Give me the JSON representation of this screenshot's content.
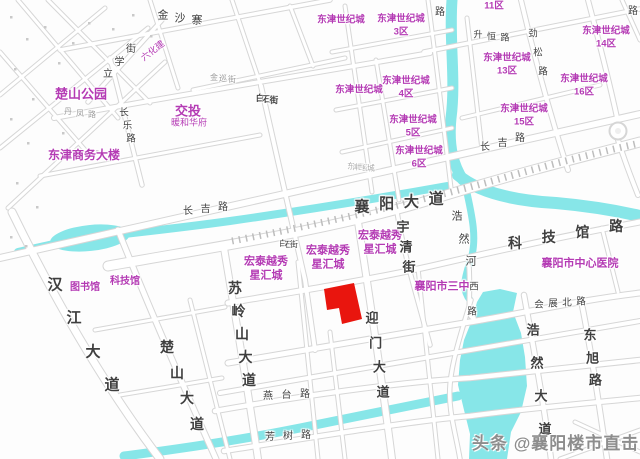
{
  "map": {
    "width": 640,
    "height": 459,
    "colors": {
      "water": "#87e6e8",
      "road_casing": "#d6d6d6",
      "road_fill": "#ffffff",
      "rail_tick": "#bdbdbd",
      "poi": "#b43bb4",
      "road_label": "#3f3f3f",
      "tiny_label": "#9b9b9b",
      "parcel": "#e9150e",
      "watermark": "#8d8d8d",
      "tree": "#c9c9c9"
    },
    "watermark": {
      "text": "头条 @襄阳楼市直击",
      "x": 472,
      "y": 429,
      "size": 17
    },
    "parcel": {
      "points": "324,289 354,283 362,319 342,324 339,308 327,310"
    },
    "roundabout": {
      "cx": 618,
      "cy": 131,
      "r": 8.5
    },
    "poi_labels": [
      {
        "lines": [
          "楚山公园"
        ],
        "x": 81,
        "y": 94,
        "size": 13,
        "bold": true
      },
      {
        "lines": [
          "东津商务大楼"
        ],
        "x": 84,
        "y": 155,
        "size": 12,
        "bold": true
      },
      {
        "lines": [
          "交投"
        ],
        "x": 188,
        "y": 111,
        "size": 13,
        "bold": true
      },
      {
        "lines": [
          "暖和华府"
        ],
        "x": 189,
        "y": 123,
        "size": 9,
        "bold": false
      },
      {
        "lines": [
          "六化建"
        ],
        "x": 153,
        "y": 51,
        "size": 9,
        "bold": false,
        "rotate": -38
      },
      {
        "lines": [
          "图书馆"
        ],
        "x": 85,
        "y": 288,
        "size": 10,
        "bold": true
      },
      {
        "lines": [
          "科技馆"
        ],
        "x": 125,
        "y": 282,
        "size": 10,
        "bold": true
      },
      {
        "lines": [
          "东津世纪城"
        ],
        "x": 341,
        "y": 20,
        "size": 9.5,
        "bold": true
      },
      {
        "lines": [
          "东津世纪城",
          "3区"
        ],
        "x": 401,
        "y": 19,
        "size": 9.5,
        "bold": true
      },
      {
        "lines": [
          "11区"
        ],
        "x": 494,
        "y": 6,
        "size": 9.5,
        "bold": true
      },
      {
        "lines": [
          "东津世纪城",
          "14区"
        ],
        "x": 606,
        "y": 31,
        "size": 9.5,
        "bold": true
      },
      {
        "lines": [
          "东津世纪城",
          "13区"
        ],
        "x": 507,
        "y": 58,
        "size": 9.5,
        "bold": true
      },
      {
        "lines": [
          "东津世纪城",
          "16区"
        ],
        "x": 584,
        "y": 79,
        "size": 9.5,
        "bold": true
      },
      {
        "lines": [
          "东津世纪城",
          "15区"
        ],
        "x": 524,
        "y": 109,
        "size": 9.5,
        "bold": true
      },
      {
        "lines": [
          "东津世纪城"
        ],
        "x": 359,
        "y": 90,
        "size": 9.5,
        "bold": true
      },
      {
        "lines": [
          "东津世纪城",
          "4区"
        ],
        "x": 406,
        "y": 81,
        "size": 9.5,
        "bold": true
      },
      {
        "lines": [
          "东津世纪城",
          "5区"
        ],
        "x": 413,
        "y": 120,
        "size": 9.5,
        "bold": true
      },
      {
        "lines": [
          "东津世纪城",
          "6区"
        ],
        "x": 419,
        "y": 151,
        "size": 9.5,
        "bold": true
      },
      {
        "lines": [
          "宏泰越秀",
          "星汇城"
        ],
        "x": 380,
        "y": 236,
        "size": 11,
        "bold": true
      },
      {
        "lines": [
          "宏泰越秀",
          "星汇城"
        ],
        "x": 328,
        "y": 251,
        "size": 11,
        "bold": true
      },
      {
        "lines": [
          "宏泰越秀",
          "星汇城"
        ],
        "x": 266,
        "y": 262,
        "size": 11,
        "bold": true
      },
      {
        "lines": [
          "襄阳市三中"
        ],
        "x": 442,
        "y": 287,
        "size": 11,
        "bold": true
      },
      {
        "lines": [
          "襄阳市中心医院"
        ],
        "x": 580,
        "y": 264,
        "size": 11,
        "bold": true
      }
    ],
    "road_labels": [
      {
        "text": "襄阳大道",
        "x": 362,
        "y": 207,
        "dx": 24.7,
        "dy": -2.7,
        "size": 15,
        "bold": true
      },
      {
        "text": "汉江大道",
        "x": 55,
        "y": 285,
        "dx": 19,
        "dy": 33.3,
        "size": 15,
        "bold": true
      },
      {
        "text": "苏岭山大道",
        "x": 235,
        "y": 288,
        "dx": 3.5,
        "dy": 23,
        "size": 14,
        "bold": true
      },
      {
        "text": "楚山大道",
        "x": 167,
        "y": 347,
        "dx": 10,
        "dy": 25.7,
        "size": 14,
        "bold": true
      },
      {
        "text": "迎门大道",
        "x": 372,
        "y": 318,
        "dx": 3.7,
        "dy": 24.7,
        "size": 13,
        "bold": true
      },
      {
        "text": "浩然大道",
        "x": 533,
        "y": 330,
        "dx": 4,
        "dy": 33,
        "size": 13,
        "bold": true
      },
      {
        "text": "东旭路",
        "x": 590,
        "y": 335,
        "dx": 2.7,
        "dy": 22.7,
        "size": 13,
        "bold": true
      },
      {
        "text": "科技馆路",
        "x": 515,
        "y": 243,
        "dx": 33.7,
        "dy": -5.7,
        "size": 14,
        "bold": true
      },
      {
        "text": "宇清街",
        "x": 403,
        "y": 227,
        "dx": 3,
        "dy": 20,
        "size": 13,
        "bold": true
      },
      {
        "text": "浩然河",
        "x": 457,
        "y": 217,
        "dx": 7,
        "dy": 22.5,
        "size": 11,
        "bold": false
      },
      {
        "text": "长吉路",
        "x": 188,
        "y": 212,
        "dx": 17.5,
        "dy": -2,
        "size": 10,
        "bold": false
      },
      {
        "text": "长吉路",
        "x": 485,
        "y": 148,
        "dx": 17.5,
        "dy": -4.5,
        "size": 10,
        "bold": false
      },
      {
        "text": "长乐路",
        "x": 124,
        "y": 113,
        "dx": 3.5,
        "dy": 13,
        "size": 9.5,
        "bold": false
      },
      {
        "text": "立学街",
        "x": 108,
        "y": 75,
        "dx": 11.5,
        "dy": -12.5,
        "size": 10,
        "bold": false
      },
      {
        "text": "金沙寨",
        "x": 163,
        "y": 16,
        "dx": 17,
        "dy": 2.5,
        "size": 11,
        "bold": false
      },
      {
        "text": "升恒路",
        "x": 478,
        "y": 35,
        "dx": 13.5,
        "dy": 1.5,
        "size": 9,
        "bold": false
      },
      {
        "text": "劲松路",
        "x": 533,
        "y": 34,
        "dx": 5,
        "dy": 19,
        "size": 9.5,
        "bold": false
      },
      {
        "text": "白石街",
        "x": 260,
        "y": 98,
        "dx": 7,
        "dy": 1,
        "size": 8.5,
        "bold": true
      },
      {
        "text": "白石街",
        "x": 283,
        "y": 244,
        "dx": 5.5,
        "dy": 0.5,
        "size": 8,
        "bold": false
      },
      {
        "text": "燕台路",
        "x": 268,
        "y": 397,
        "dx": 18.5,
        "dy": -1,
        "size": 10,
        "bold": false
      },
      {
        "text": "芳树路",
        "x": 270,
        "y": 438,
        "dx": 18,
        "dy": -1,
        "size": 10,
        "bold": false
      },
      {
        "text": "会展北路",
        "x": 539,
        "y": 305,
        "dx": 14,
        "dy": -1,
        "size": 9.5,
        "bold": false
      },
      {
        "text": "西路",
        "x": 474,
        "y": 287,
        "dx": -2,
        "dy": 25,
        "size": 9.5,
        "bold": false
      },
      {
        "text": "金巡街",
        "x": 214,
        "y": 78,
        "dx": 9,
        "dy": 1,
        "size": 8,
        "bold": false,
        "color": "#9b9b9b"
      },
      {
        "text": "丹凤路",
        "x": 68,
        "y": 112,
        "dx": 12,
        "dy": 1.5,
        "size": 8,
        "bold": false,
        "color": "#9b9b9b"
      },
      {
        "text": "东津世纪城",
        "x": 351,
        "y": 166,
        "dx": 5,
        "dy": 0.6,
        "size": 7.5,
        "bold": false,
        "color": "#aaaaaa"
      },
      {
        "text": "路",
        "x": 440,
        "y": 13,
        "dx": 0,
        "dy": 0,
        "size": 10,
        "bold": false
      },
      {
        "text": "路",
        "x": 633,
        "y": 12,
        "dx": 0,
        "dy": 0,
        "size": 10,
        "bold": false
      }
    ],
    "waterways": [
      {
        "d": "M18,252 C40,247 60,242 90,238 C140,232 180,228 230,221 C300,211 380,198 447,186",
        "w": 8
      },
      {
        "d": "M452,0 C449,40 456,80 451,118 C448,148 454,166 463,180",
        "w": 11
      },
      {
        "d": "M458,175 C480,194 520,201 556,203 C590,206 618,211 640,216",
        "w": 12
      },
      {
        "d": "M465,184 C472,215 478,240 470,262 C464,280 462,290 470,300",
        "w": 7
      },
      {
        "d": "M124,456 C180,449 240,440 300,428 C360,416 420,404 458,396",
        "w": 9
      }
    ],
    "lake_points": "483,292 500,289 517,293 513,312 521,333 525,357 527,386 521,412 511,432 507,459 469,459 470,434 464,410 458,385 460,360 464,340 472,320 477,302",
    "water_bulge": {
      "cx": 90,
      "cy": 238,
      "rx": 40,
      "ry": 13,
      "rotate": -6
    },
    "rail_tick_path": "M232,241 C320,224 430,199 510,176 C560,162 600,152 640,143",
    "roads": [
      {
        "d": "M60,50 L330,0",
        "w": 3.5
      },
      {
        "d": "M88,102 L162,20",
        "w": 3.5
      },
      {
        "d": "M0,258 L640,114",
        "w": 6
      },
      {
        "d": "M108,266 C220,246 330,230 430,200 C500,178 570,160 640,142",
        "w": 9
      },
      {
        "d": "M228,303 C300,291 380,278 440,264 C500,250 570,235 640,222",
        "w": 5
      },
      {
        "d": "M228,363 C320,348 420,330 470,322 C530,312 580,300 640,293",
        "w": 5
      },
      {
        "d": "M220,393 L640,321",
        "w": 4
      },
      {
        "d": "M215,411 C300,396 400,382 470,378 C530,372 580,366 640,360",
        "w": 4.5
      },
      {
        "d": "M224,451 C320,436 420,420 470,416 C530,408 580,404 640,398",
        "w": 4.5
      },
      {
        "d": "M424,52 L640,9",
        "w": 3.5
      },
      {
        "d": "M54,118 C150,100 250,84 430,53",
        "w": 4
      },
      {
        "d": "M193,90 L345,58",
        "w": 3
      },
      {
        "d": "M40,176 L260,135",
        "w": 3
      },
      {
        "d": "M332,52 L452,30",
        "w": 3
      },
      {
        "d": "M336,110 L452,88",
        "w": 3
      },
      {
        "d": "M342,152 L452,128",
        "w": 3
      },
      {
        "d": "M462,118 L600,85",
        "w": 3
      },
      {
        "d": "M95,330 L225,307",
        "w": 3
      },
      {
        "d": "M120,395 L222,378",
        "w": 3
      },
      {
        "d": "M12,212 C50,290 100,380 160,459",
        "w": 7
      },
      {
        "d": "M118,230 C150,310 185,390 216,459",
        "w": 5
      },
      {
        "d": "M224,248 C236,320 248,390 258,459",
        "w": 6
      },
      {
        "d": "M358,222 C370,300 382,380 392,459",
        "w": 6
      },
      {
        "d": "M261,86 C275,150 292,220 305,280 L315,350",
        "w": 4
      },
      {
        "d": "M110,58 L142,185",
        "w": 3.5
      },
      {
        "d": "M397,212 C405,260 418,300 430,345",
        "w": 3.5
      },
      {
        "d": "M469,266 C471,300 466,318 474,318",
        "w": 3.5
      },
      {
        "d": "M471,300 C462,330 452,360 450,385 C448,410 455,430 460,459",
        "w": 3.5
      },
      {
        "d": "M521,0 C535,60 552,120 568,170",
        "w": 4
      },
      {
        "d": "M524,295 C534,350 544,405 551,459",
        "w": 4.5
      },
      {
        "d": "M582,305 C592,355 600,410 607,459",
        "w": 4.5
      },
      {
        "d": "M345,6 L372,192",
        "w": 3
      },
      {
        "d": "M376,60 L399,200",
        "w": 3
      },
      {
        "d": "M428,0 C436,60 444,130 452,196",
        "w": 3
      },
      {
        "d": "M467,18 L482,150",
        "w": 3
      },
      {
        "d": "M588,0 C600,45 610,85 618,122",
        "w": 4
      },
      {
        "d": "M618,140 C626,165 632,180 638,195",
        "w": 4
      },
      {
        "d": "M622,0 L640,40",
        "w": 3
      },
      {
        "d": "M150,0 L178,88",
        "w": 3
      },
      {
        "d": "M232,0 L261,86",
        "w": 3
      },
      {
        "d": "M290,6 L313,66",
        "w": 3
      },
      {
        "d": "M418,268 L438,459",
        "w": 3
      },
      {
        "d": "M298,262 L318,459",
        "w": 3
      },
      {
        "d": "M330,332 L345,459",
        "w": 3
      },
      {
        "d": "M190,300 L230,459",
        "w": 3
      },
      {
        "d": "M602,228 L618,292",
        "w": 3
      },
      {
        "d": "M560,459 L640,430",
        "w": 3
      },
      {
        "d": "M575,422 L640,452",
        "w": 3
      },
      {
        "d": "M0,95 L105,8",
        "w": 3
      },
      {
        "d": "M0,148 L148,28",
        "w": 3
      },
      {
        "d": "M8,208 L165,62",
        "w": 3
      },
      {
        "d": "M18,0 L118,118",
        "w": 3
      },
      {
        "d": "M48,0 L150,103",
        "w": 3
      },
      {
        "d": "M0,52 L92,158",
        "w": 3
      }
    ],
    "trees": [
      [
        10,
        16
      ],
      [
        26,
        38
      ],
      [
        44,
        26
      ],
      [
        14,
        68
      ],
      [
        32,
        98
      ],
      [
        58,
        62
      ],
      [
        72,
        42
      ],
      [
        88,
        22
      ],
      [
        10,
        118
      ],
      [
        27,
        142
      ],
      [
        62,
        132
      ],
      [
        16,
        182
      ],
      [
        36,
        206
      ],
      [
        10,
        236
      ],
      [
        112,
        28
      ],
      [
        132,
        14
      ],
      [
        150,
        35
      ],
      [
        96,
        150
      ],
      [
        25,
        245
      ]
    ]
  }
}
